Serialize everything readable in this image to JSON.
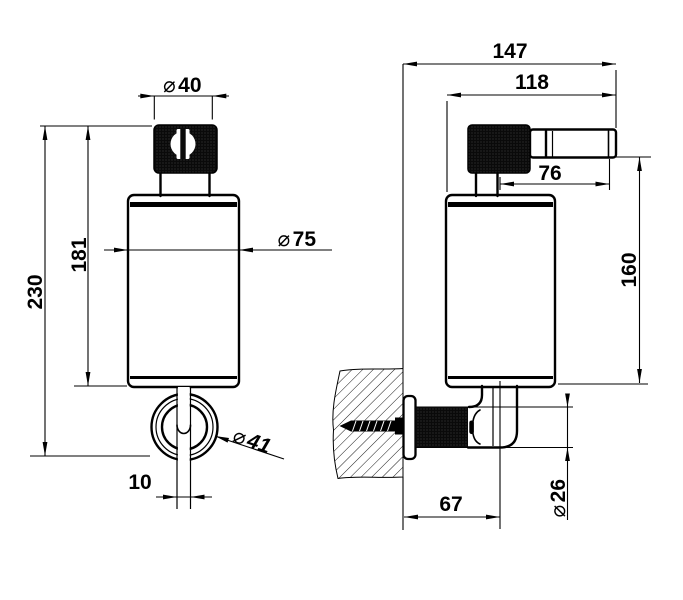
{
  "drawing": {
    "background_color": "#ffffff",
    "line_color": "#000000",
    "dimensions": {
      "dia40": {
        "symbol": "⌀",
        "value": "40"
      },
      "h181": {
        "value": "181"
      },
      "h230": {
        "value": "230"
      },
      "dia75": {
        "symbol": "⌀",
        "value": "75"
      },
      "dia41": {
        "symbol": "⌀",
        "value": "41"
      },
      "w10": {
        "value": "10"
      },
      "w147": {
        "value": "147"
      },
      "w118": {
        "value": "118"
      },
      "w76": {
        "value": "76"
      },
      "h160": {
        "value": "160"
      },
      "w67": {
        "value": "67"
      },
      "dia26": {
        "symbol": "⌀",
        "value": "26"
      }
    }
  }
}
